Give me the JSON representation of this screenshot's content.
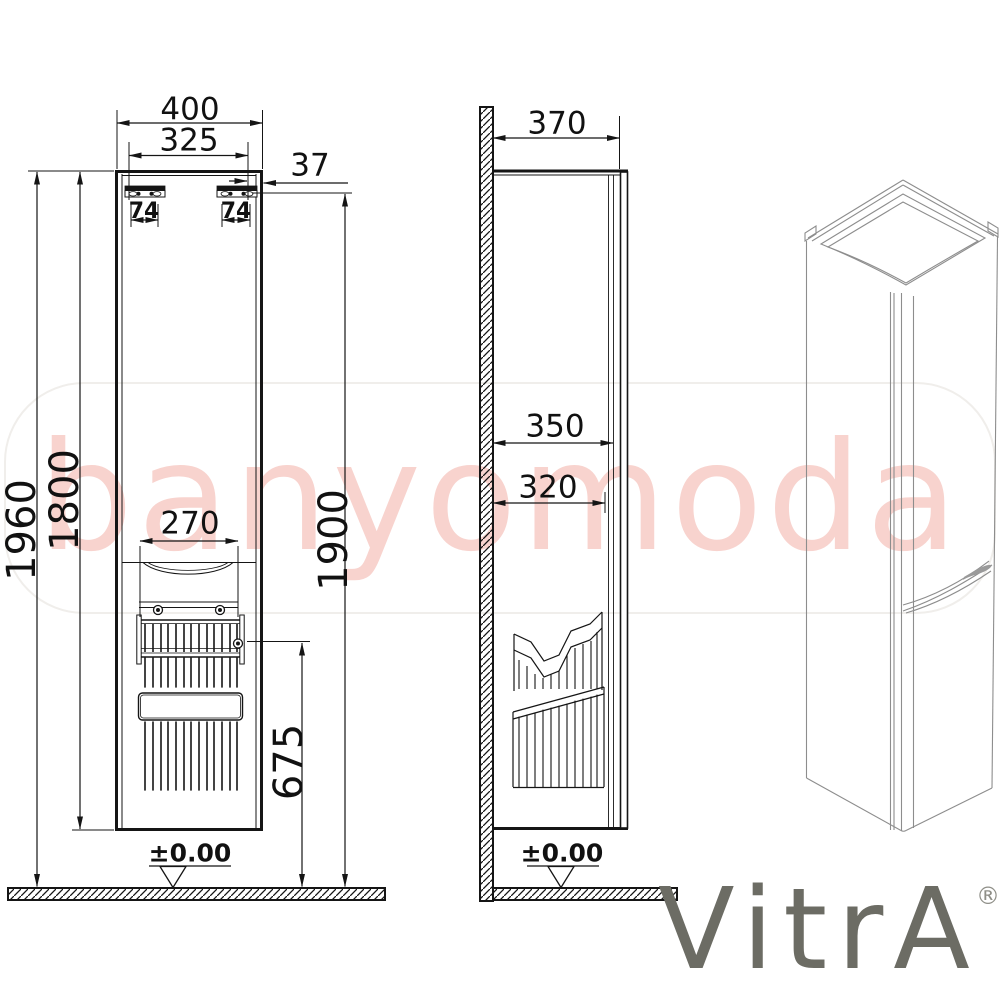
{
  "watermark": {
    "text": "banyomoda",
    "color": "#f8d3ce",
    "frame_color": "#f0eeeb"
  },
  "brand": {
    "name": "VitrA",
    "registered_mark": "®",
    "color": "#6c6c64"
  },
  "front_view": {
    "width_overall": "400",
    "width_inner": "325",
    "gap_right": "37",
    "bracket_left": "74",
    "bracket_right": "74",
    "height_overall": "1960",
    "height_cabinet": "1800",
    "height_rail": "1900",
    "basket_width": "270",
    "basket_level": "675",
    "floor_level": "±0.00"
  },
  "side_view": {
    "depth_overall": "370",
    "depth_inner": "350",
    "depth_basket": "320",
    "floor_level": "±0.00"
  },
  "colors": {
    "line": "#151515",
    "iso_line": "#8d8d8d",
    "hatch": "#151515"
  }
}
